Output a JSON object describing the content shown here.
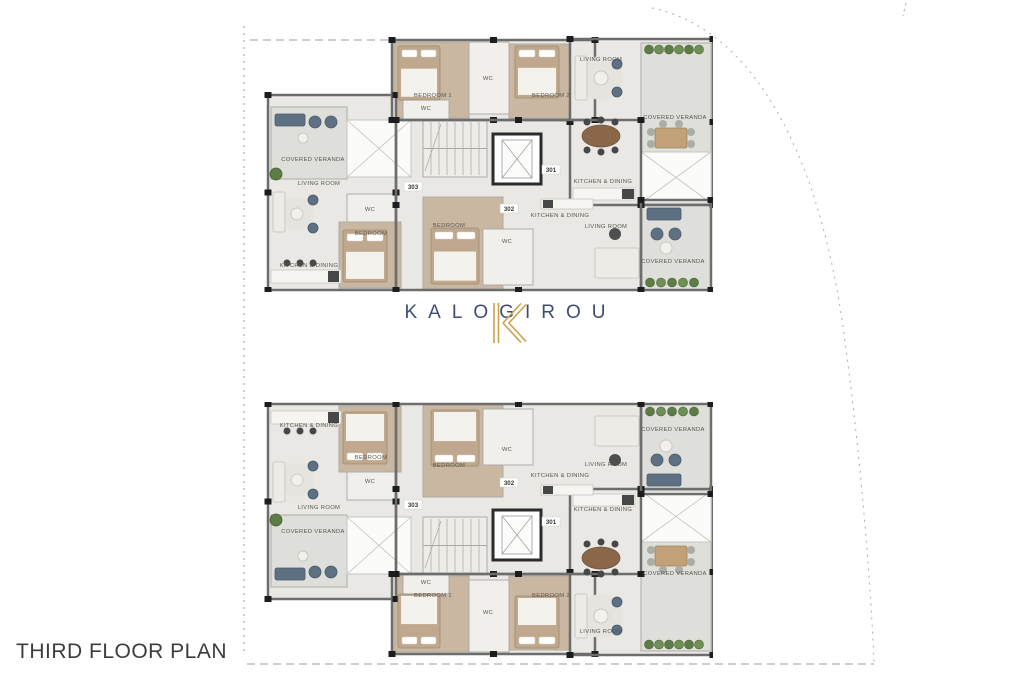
{
  "title": {
    "text": "THIRD FLOOR PLAN"
  },
  "logo": {
    "brand": "KALOGIROU",
    "mark": "K"
  },
  "colors": {
    "background": "#ffffff",
    "wall": "#6d6d6d",
    "innerWall": "#aeada8",
    "column": "#1d1d1d",
    "tile": "#e9e8e4",
    "wood": "#c9b7a1",
    "bath": "#f0efec",
    "veranda": "#dededa",
    "voidFill": "#fbfbf9",
    "voidLine": "#c5c4bf",
    "stairFill": "#edece8",
    "stairLine": "#a9a8a2",
    "bedBase": "#bfa88d",
    "bedSheet": "#f4f2ed",
    "bedStroke": "#a08a6d",
    "sofaLight": "#ecebe5",
    "sofaLightStroke": "#c3c1b9",
    "navyFurn": "#5e7183",
    "navyFurnStroke": "#49596a",
    "grayChair": "#a9aea6",
    "tableWoodOval": "#8a6749",
    "tableWoodRect": "#c2a178",
    "counter": "#f6f5f2",
    "counterStroke": "#c8c6bf",
    "appliance": "#474747",
    "plantA": "#5d7c46",
    "plantB": "#6f9055",
    "plantStroke": "#44602e",
    "rug": "#e6e4de",
    "tableDark": "#4f4f4f",
    "tableRound": "#f1f0ec",
    "label": "#56564f",
    "unit": "#38383a",
    "boundary": "#9c9c9c",
    "logoGold": "#c9a24b",
    "logoNavy": "#3e4e73",
    "titleColor": "#3c3c3c"
  },
  "plan_template": {
    "w": 470,
    "h": 270,
    "rooms": [
      {
        "name": "strip-base-301",
        "x": 149,
        "y": 18,
        "w": 203,
        "h": 80,
        "fill": "tile"
      },
      {
        "name": "bedroom-1-301",
        "x": 151,
        "y": 20,
        "w": 75,
        "h": 76,
        "fill": "wood"
      },
      {
        "name": "wc-301",
        "x": 226,
        "y": 20,
        "w": 40,
        "h": 72,
        "fill": "bath"
      },
      {
        "name": "bedroom-2-301",
        "x": 266,
        "y": 22,
        "w": 84,
        "h": 74,
        "fill": "wood"
      },
      {
        "name": "living-block-301",
        "x": 327,
        "y": 17,
        "w": 143,
        "h": 166,
        "fill": "tile"
      },
      {
        "name": "veranda-301",
        "x": 398,
        "y": 21,
        "w": 70,
        "h": 160,
        "fill": "veranda"
      },
      {
        "name": "left-block-303",
        "x": 25,
        "y": 73,
        "w": 128,
        "h": 195,
        "fill": "tile"
      },
      {
        "name": "veranda-303",
        "x": 28,
        "y": 85,
        "w": 76,
        "h": 72,
        "fill": "veranda"
      },
      {
        "name": "core-block",
        "x": 153,
        "y": 98,
        "w": 245,
        "h": 170,
        "fill": "tile"
      },
      {
        "name": "ensuite-wc-301",
        "x": 160,
        "y": 78,
        "w": 46,
        "h": 20,
        "fill": "bath"
      },
      {
        "name": "wc-303",
        "x": 104,
        "y": 172,
        "w": 48,
        "h": 30,
        "fill": "bath"
      },
      {
        "name": "bedroom-303",
        "x": 96,
        "y": 200,
        "w": 62,
        "h": 66,
        "fill": "wood"
      },
      {
        "name": "bedroom-302",
        "x": 180,
        "y": 175,
        "w": 80,
        "h": 93,
        "fill": "wood"
      },
      {
        "name": "wc-302",
        "x": 240,
        "y": 207,
        "w": 50,
        "h": 56,
        "fill": "bath"
      },
      {
        "name": "veranda-302",
        "x": 398,
        "y": 178,
        "w": 70,
        "h": 90,
        "fill": "veranda"
      }
    ],
    "voids": [
      [
        104,
        98,
        64,
        57
      ],
      [
        398,
        130,
        70,
        51
      ]
    ],
    "stairs": [
      180,
      98,
      64,
      57
    ],
    "elevator": [
      250,
      112,
      48,
      50
    ],
    "walls": [
      [
        149,
        18,
        203,
        80
      ],
      [
        327,
        17,
        143,
        166
      ],
      [
        25,
        73,
        128,
        195
      ],
      [
        153,
        98,
        245,
        170
      ],
      [
        398,
        178,
        70,
        90
      ]
    ],
    "labels": [
      {
        "text": "BEDROOM 1",
        "x": 190,
        "y": 75
      },
      {
        "text": "WC",
        "x": 245,
        "y": 58
      },
      {
        "text": "BEDROOM 2",
        "x": 308,
        "y": 75
      },
      {
        "text": "LIVING ROOM",
        "x": 358,
        "y": 39
      },
      {
        "text": "COVERED VERANDA",
        "x": 432,
        "y": 97
      },
      {
        "text": "KITCHEN & DINING",
        "x": 360,
        "y": 161
      },
      {
        "text": "WC",
        "x": 183,
        "y": 88
      },
      {
        "text": "COVERED VERANDA",
        "x": 70,
        "y": 139
      },
      {
        "text": "LIVING ROOM",
        "x": 76,
        "y": 163
      },
      {
        "text": "WC",
        "x": 127,
        "y": 189
      },
      {
        "text": "BEDROOM",
        "x": 128,
        "y": 213
      },
      {
        "text": "KITCHEN & DINING",
        "x": 66,
        "y": 245
      },
      {
        "text": "BEDROOM",
        "x": 206,
        "y": 205
      },
      {
        "text": "WC",
        "x": 264,
        "y": 221
      },
      {
        "text": "KITCHEN & DINING",
        "x": 317,
        "y": 195
      },
      {
        "text": "LIVING ROOM",
        "x": 363,
        "y": 206
      },
      {
        "text": "COVERED VERANDA",
        "x": 430,
        "y": 241
      }
    ],
    "units": [
      {
        "text": "303",
        "x": 170,
        "y": 166
      },
      {
        "text": "301",
        "x": 308,
        "y": 149
      },
      {
        "text": "302",
        "x": 266,
        "y": 188
      }
    ],
    "furniture": [
      {
        "type": "rug",
        "cx": 358,
        "cy": 56,
        "r": 22
      },
      {
        "type": "rug",
        "cx": 54,
        "cy": 192,
        "r": 17
      },
      {
        "type": "bed",
        "x": 155,
        "y": 24,
        "w": 42,
        "h": 54
      },
      {
        "type": "bed",
        "x": 272,
        "y": 24,
        "w": 44,
        "h": 52
      },
      {
        "type": "bed",
        "x": 100,
        "y": 208,
        "w": 44,
        "h": 52
      },
      {
        "type": "bed",
        "x": 188,
        "y": 206,
        "w": 48,
        "h": 56
      },
      {
        "type": "sofa",
        "x": 332,
        "y": 34,
        "w": 12,
        "h": 44
      },
      {
        "type": "table-round",
        "cx": 358,
        "cy": 56,
        "r": 7
      },
      {
        "type": "chair",
        "cx": 374,
        "cy": 42,
        "r": 5
      },
      {
        "type": "chair",
        "cx": 374,
        "cy": 70,
        "r": 5
      },
      {
        "type": "table-oval",
        "cx": 358,
        "cy": 114,
        "rx": 19,
        "ry": 11
      },
      {
        "type": "stool",
        "cx": 344,
        "cy": 100,
        "r": 3.5
      },
      {
        "type": "stool",
        "cx": 358,
        "cy": 98,
        "r": 3.5
      },
      {
        "type": "stool",
        "cx": 372,
        "cy": 100,
        "r": 3.5
      },
      {
        "type": "stool",
        "cx": 344,
        "cy": 128,
        "r": 3.5
      },
      {
        "type": "stool",
        "cx": 358,
        "cy": 130,
        "r": 3.5
      },
      {
        "type": "stool",
        "cx": 372,
        "cy": 128,
        "r": 3.5
      },
      {
        "type": "counter",
        "x": 330,
        "y": 166,
        "w": 62,
        "h": 12
      },
      {
        "type": "appliance",
        "x": 379,
        "y": 167,
        "w": 12,
        "h": 10
      },
      {
        "type": "plant-row",
        "x": 401,
        "y": 23,
        "w": 60,
        "h": 9
      },
      {
        "type": "table-wood",
        "x": 412,
        "y": 106,
        "w": 32,
        "h": 20
      },
      {
        "type": "chair-gray",
        "cx": 408,
        "cy": 110,
        "r": 4
      },
      {
        "type": "chair-gray",
        "cx": 408,
        "cy": 122,
        "r": 4
      },
      {
        "type": "chair-gray",
        "cx": 448,
        "cy": 110,
        "r": 4
      },
      {
        "type": "chair-gray",
        "cx": 448,
        "cy": 122,
        "r": 4
      },
      {
        "type": "chair-gray",
        "cx": 420,
        "cy": 102,
        "r": 4
      },
      {
        "type": "chair-gray",
        "cx": 436,
        "cy": 102,
        "r": 4
      },
      {
        "type": "sofa-dark",
        "x": 32,
        "y": 92,
        "w": 30,
        "h": 12
      },
      {
        "type": "chair",
        "cx": 72,
        "cy": 100,
        "r": 6
      },
      {
        "type": "chair",
        "cx": 88,
        "cy": 100,
        "r": 6
      },
      {
        "type": "table-round",
        "cx": 60,
        "cy": 116,
        "r": 5
      },
      {
        "type": "plant",
        "cx": 33,
        "cy": 152,
        "r": 6
      },
      {
        "type": "sofa",
        "x": 30,
        "y": 170,
        "w": 12,
        "h": 40
      },
      {
        "type": "table-round",
        "cx": 54,
        "cy": 192,
        "r": 6
      },
      {
        "type": "chair",
        "cx": 70,
        "cy": 178,
        "r": 5
      },
      {
        "type": "chair",
        "cx": 70,
        "cy": 206,
        "r": 5
      },
      {
        "type": "counter",
        "x": 28,
        "y": 248,
        "w": 70,
        "h": 13
      },
      {
        "type": "stool",
        "cx": 44,
        "cy": 241,
        "r": 3.5
      },
      {
        "type": "stool",
        "cx": 57,
        "cy": 241,
        "r": 3.5
      },
      {
        "type": "stool",
        "cx": 70,
        "cy": 241,
        "r": 3.5
      },
      {
        "type": "appliance",
        "x": 85,
        "y": 249,
        "w": 11,
        "h": 11
      },
      {
        "type": "counter",
        "x": 298,
        "y": 177,
        "w": 52,
        "h": 10
      },
      {
        "type": "appliance",
        "x": 300,
        "y": 178,
        "w": 10,
        "h": 8
      },
      {
        "type": "sofa",
        "x": 352,
        "y": 226,
        "w": 44,
        "h": 30
      },
      {
        "type": "table-dark",
        "cx": 372,
        "cy": 212,
        "r": 6
      },
      {
        "type": "sofa-dark",
        "x": 404,
        "y": 186,
        "w": 34,
        "h": 12
      },
      {
        "type": "chair",
        "cx": 414,
        "cy": 212,
        "r": 6
      },
      {
        "type": "chair",
        "cx": 432,
        "cy": 212,
        "r": 6
      },
      {
        "type": "table-round",
        "cx": 423,
        "cy": 226,
        "r": 6
      },
      {
        "type": "plant-row",
        "x": 402,
        "y": 256,
        "w": 54,
        "h": 9
      }
    ]
  },
  "plans": [
    {
      "id": "upper-block",
      "left": 243,
      "top": 22,
      "mirrored": false
    },
    {
      "id": "lower-block",
      "left": 243,
      "top": 402,
      "mirrored": true
    }
  ]
}
